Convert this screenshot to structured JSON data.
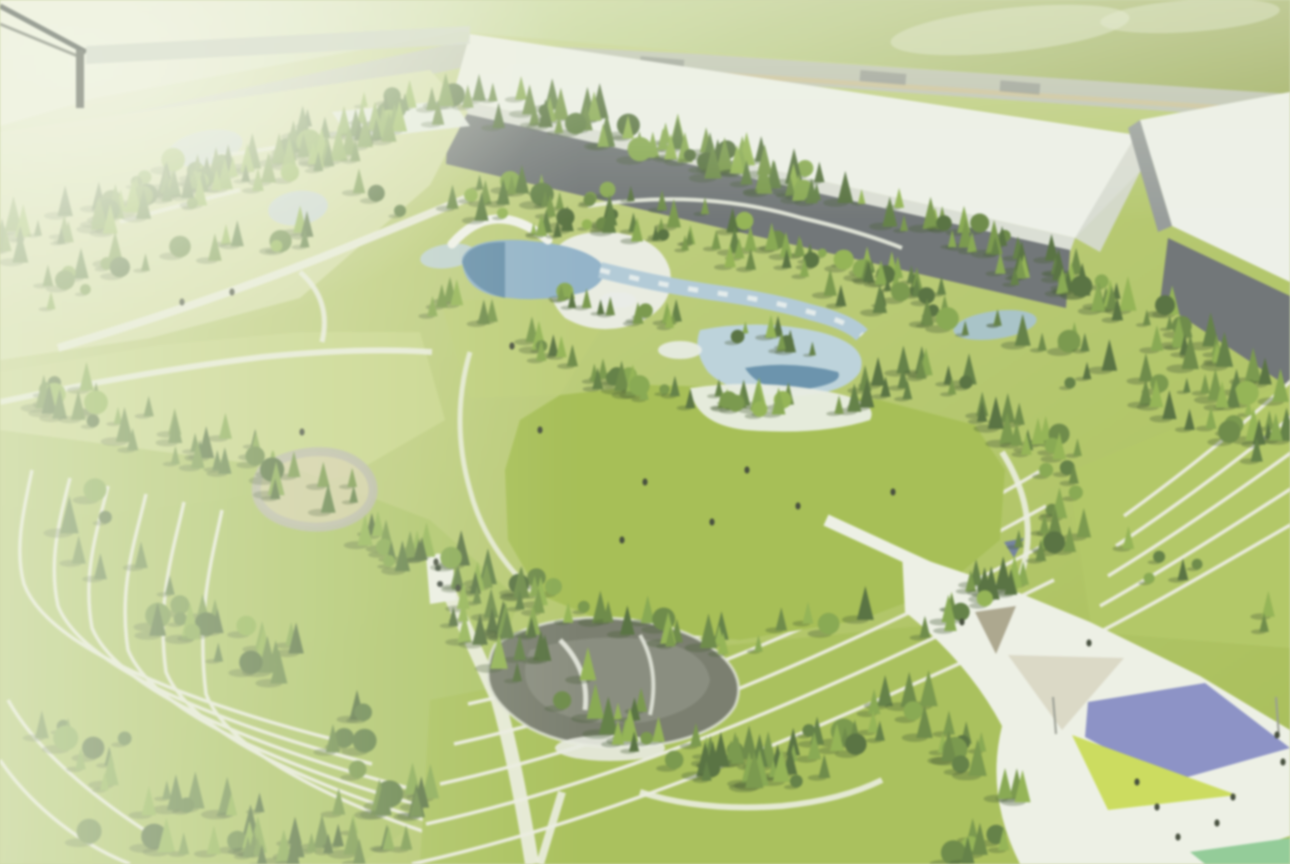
{
  "scene": {
    "name": "aerial-park-masterplan-rendering",
    "alt": "Bird's-eye 3D rendering of a landscaped park with forests, terraced lawns, water gardens, a pond and a plaza with colored canopies, bordered by long warehouse buildings"
  },
  "palette": {
    "base_lawn_a": "#c6d287",
    "base_lawn_b": "#9db73f",
    "field_left": "#e7ebd0",
    "field_mid": "#bed185",
    "field_right": "#8e9f43",
    "road": "#b6baae",
    "road_stripe": "#c9b989",
    "roof_white": "#eef0ec",
    "roof_shade": "#d9dcd6",
    "facade_dark": "#5f646a",
    "facade_mid": "#8b9092",
    "gap_paved": "#d4d7d0",
    "lawn_left_light": "#d3dc9e",
    "lawn_left": "#c3d27c",
    "lawn_pocket": "#b7c968",
    "meadow": "#9cb83e",
    "path": "#ebede1",
    "terrace_line": "#edeee4",
    "terrace_green_sw": "#a3bd52",
    "terrace_green_se": "#a0ba46",
    "slope_green_e": "#abc253",
    "water_light": "#a9c5d9",
    "water_mid": "#85abc9",
    "water_dark": "#47789f",
    "deck": "#e9ece4",
    "pond_dark": "#696d5f",
    "pond_mid": "#878b7d",
    "plaza_white": "#eef0e8",
    "tri_tan_dark": "#a49c83",
    "tri_tan_light": "#d9d5c3",
    "canopy_purple": "#7e84c6",
    "canopy_yellow": "#c8da48",
    "tri_teal": "#84c78e",
    "canopy_navy": "#5a6aa0",
    "structure_blue": "#c3d2da",
    "greenhouse_white": "#e9edec",
    "loop_tan": "#d2cba2",
    "loop_gray": "#b4b3a2",
    "figure": "#2e3626",
    "beam": "#9aa096",
    "haze": "#eff3e0"
  },
  "vegetation": {
    "seed": 7,
    "shadow": "#32491f",
    "colors": [
      "#42602a",
      "#4e7030",
      "#5a7c33",
      "#688c36",
      "#79a03c",
      "#86ad3f"
    ],
    "belts": [
      {
        "name": "north-tree-belt",
        "points": [
          [
            0,
            245
          ],
          [
            140,
            200
          ],
          [
            300,
            150
          ],
          [
            460,
            95
          ],
          [
            640,
            140
          ],
          [
            820,
            190
          ],
          [
            1000,
            260
          ],
          [
            1150,
            320
          ],
          [
            1290,
            395
          ]
        ],
        "count": 200,
        "jitter": 30,
        "size": [
          6,
          15
        ],
        "round": 0.18
      },
      {
        "name": "north-inner-belt",
        "points": [
          [
            0,
            300
          ],
          [
            200,
            250
          ],
          [
            400,
            200
          ],
          [
            560,
            200
          ],
          [
            700,
            235
          ],
          [
            900,
            300
          ],
          [
            1100,
            370
          ],
          [
            1230,
            420
          ],
          [
            1290,
            455
          ]
        ],
        "count": 110,
        "jitter": 30,
        "size": [
          6,
          14
        ],
        "round": 0.2
      },
      {
        "name": "upper-left-grove",
        "points": [
          [
            120,
            215
          ],
          [
            220,
            185
          ],
          [
            330,
            150
          ],
          [
            420,
            120
          ]
        ],
        "count": 40,
        "jitter": 24,
        "size": [
          6,
          13
        ],
        "round": 0.2
      },
      {
        "name": "pool-north-grove",
        "points": [
          [
            500,
            230
          ],
          [
            620,
            230
          ],
          [
            740,
            250
          ],
          [
            860,
            270
          ],
          [
            950,
            300
          ]
        ],
        "count": 38,
        "jitter": 16,
        "size": [
          5,
          12
        ],
        "round": 0.15
      },
      {
        "name": "pool-inner-grove",
        "points": [
          [
            560,
            300
          ],
          [
            700,
            330
          ],
          [
            820,
            350
          ]
        ],
        "count": 22,
        "jitter": 14,
        "size": [
          5,
          10
        ],
        "round": 0.2
      },
      {
        "name": "pool-south-grove",
        "points": [
          [
            440,
            300
          ],
          [
            540,
            350
          ],
          [
            640,
            390
          ],
          [
            760,
            410
          ],
          [
            870,
            400
          ],
          [
            950,
            360
          ]
        ],
        "count": 55,
        "jitter": 22,
        "size": [
          6,
          13
        ],
        "round": 0.2
      },
      {
        "name": "west-scatter",
        "points": [
          [
            20,
            380
          ],
          [
            120,
            420
          ],
          [
            230,
            460
          ],
          [
            330,
            500
          ]
        ],
        "count": 38,
        "jitter": 34,
        "size": [
          7,
          15
        ],
        "round": 0.25
      },
      {
        "name": "meadow-south-grove",
        "points": [
          [
            360,
            540
          ],
          [
            470,
            580
          ],
          [
            600,
            625
          ],
          [
            740,
            645
          ],
          [
            860,
            625
          ]
        ],
        "count": 50,
        "jitter": 22,
        "size": [
          7,
          15
        ],
        "round": 0.2
      },
      {
        "name": "pond-grove",
        "points": [
          [
            450,
            610
          ],
          [
            530,
            660
          ],
          [
            610,
            720
          ],
          [
            700,
            760
          ],
          [
            800,
            770
          ],
          [
            870,
            720
          ]
        ],
        "count": 70,
        "jitter": 30,
        "size": [
          7,
          16
        ],
        "round": 0.2
      },
      {
        "name": "east-belt",
        "points": [
          [
            950,
            370
          ],
          [
            1020,
            430
          ],
          [
            1080,
            480
          ],
          [
            1060,
            540
          ],
          [
            1000,
            590
          ],
          [
            930,
            630
          ]
        ],
        "count": 50,
        "jitter": 24,
        "size": [
          7,
          14
        ],
        "round": 0.2
      },
      {
        "name": "southwest-scatter",
        "points": [
          [
            40,
            500
          ],
          [
            140,
            580
          ],
          [
            260,
            660
          ],
          [
            370,
            740
          ],
          [
            420,
            820
          ],
          [
            300,
            840
          ],
          [
            150,
            800
          ],
          [
            60,
            720
          ]
        ],
        "count": 70,
        "jitter": 40,
        "size": [
          7,
          16
        ],
        "round": 0.22
      },
      {
        "name": "south-edge-grove",
        "points": [
          [
            100,
            840
          ],
          [
            260,
            856
          ],
          [
            400,
            850
          ]
        ],
        "count": 18,
        "jitter": 16,
        "size": [
          8,
          16
        ],
        "round": 0.25
      },
      {
        "name": "east-slope-scatter",
        "points": [
          [
            1150,
            560
          ],
          [
            1230,
            600
          ],
          [
            1280,
            640
          ]
        ],
        "count": 7,
        "jitter": 26,
        "size": [
          6,
          11
        ],
        "round": 0.3
      },
      {
        "name": "plaza-edge-grove",
        "points": [
          [
            900,
            700
          ],
          [
            960,
            760
          ],
          [
            1020,
            820
          ],
          [
            960,
            860
          ]
        ],
        "count": 24,
        "jitter": 26,
        "size": [
          8,
          16
        ],
        "round": 0.2
      }
    ]
  },
  "figures": {
    "positions": [
      [
        645,
        482
      ],
      [
        747,
        470
      ],
      [
        798,
        506
      ],
      [
        712,
        522
      ],
      [
        622,
        540
      ],
      [
        893,
        492
      ],
      [
        540,
        430
      ],
      [
        182,
        302
      ],
      [
        232,
        292
      ],
      [
        512,
        346
      ],
      [
        436,
        562
      ],
      [
        458,
        588
      ],
      [
        302,
        432
      ],
      [
        1157,
        807
      ],
      [
        1233,
        797
      ],
      [
        1217,
        823
      ],
      [
        1178,
        837
      ],
      [
        1277,
        735
      ],
      [
        1283,
        762
      ],
      [
        1137,
        782
      ],
      [
        1089,
        643
      ],
      [
        962,
        622
      ]
    ]
  }
}
